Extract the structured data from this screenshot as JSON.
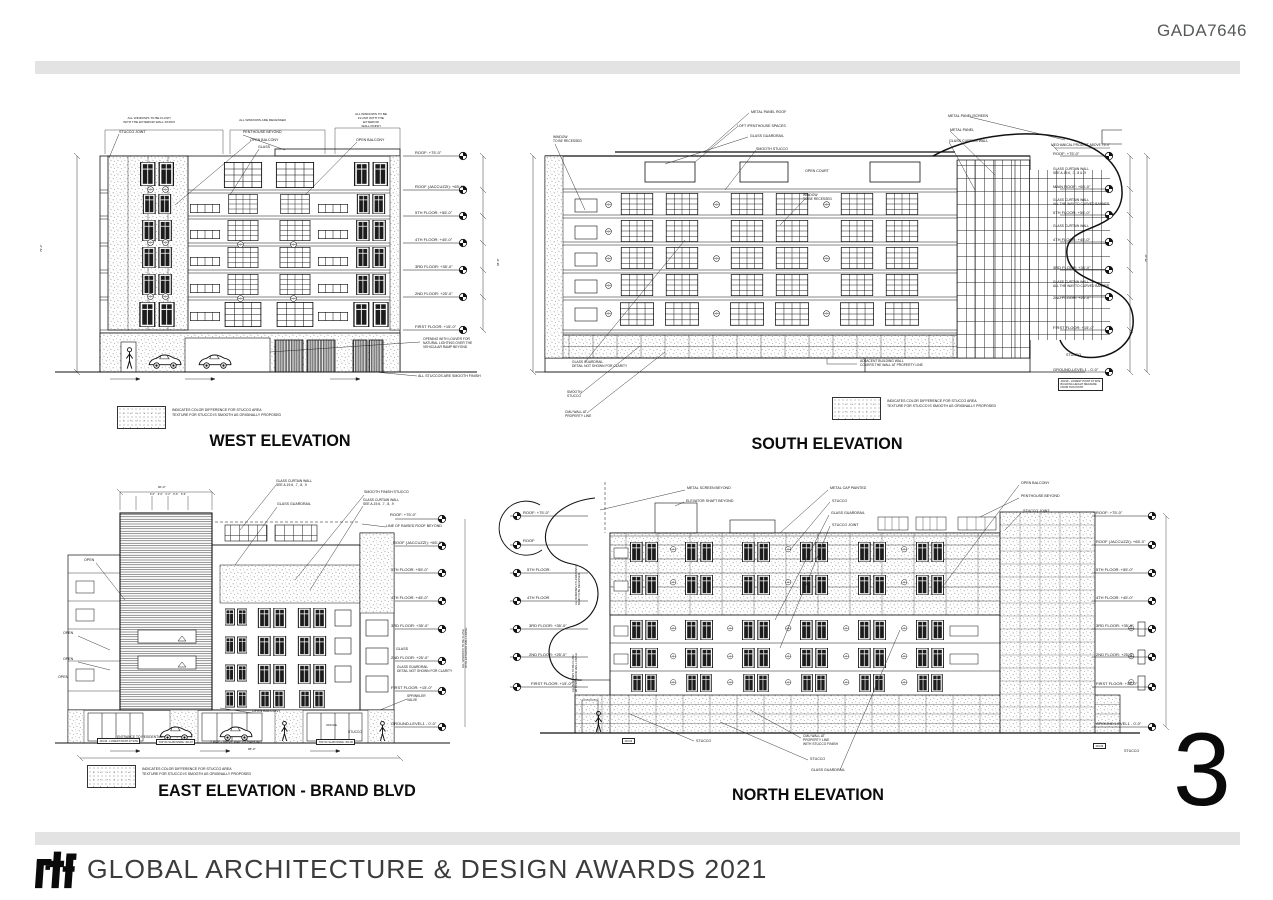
{
  "header": {
    "code": "GADA7646"
  },
  "page_number": "3",
  "footer": {
    "logo_text": "rtf",
    "award_text": "GLOBAL ARCHITECTURE & DESIGN AWARDS 2021"
  },
  "titles": {
    "west": "WEST ELEVATION",
    "south": "SOUTH ELEVATION",
    "east": "EAST ELEVATION - BRAND BLVD",
    "north": "NORTH ELEVATION"
  },
  "legend": {
    "line1": "INDICATES COLOR DIFFERENCE FOR STUCCO AREA",
    "line2": "TEXTURE FOR STUCCO IS SMOOTH AS ORIGINALLY PROPOSED",
    "positions": [
      {
        "x": 117,
        "y": 406
      },
      {
        "x": 832,
        "y": 397
      },
      {
        "x": 87,
        "y": 765
      }
    ]
  },
  "annotations": [
    {
      "t": "ALL WINDOWS TO BE FLUSH\nWITH THE EXTERIOR WALL FINISH",
      "x": 103,
      "y": 117,
      "fs": 3.1,
      "w": 92,
      "al": "center"
    },
    {
      "t": "ALL WINDOWS ARE RECESSED",
      "x": 215,
      "y": 119,
      "fs": 3.1,
      "w": 95,
      "al": "center"
    },
    {
      "t": "ALL WINDOWS TO BE\nFLUSH WITH THE\nEXTERIOR\nWALL FINISH",
      "x": 342,
      "y": 113,
      "fs": 3.1,
      "w": 58,
      "al": "center"
    },
    {
      "t": "STUCCO JOINT",
      "x": 119,
      "y": 130
    },
    {
      "t": "PENTHOUSE BEYOND",
      "x": 243,
      "y": 130
    },
    {
      "t": "OPEN BALCONY",
      "x": 250,
      "y": 138
    },
    {
      "t": "GLASS",
      "x": 258,
      "y": 145
    },
    {
      "t": "OPEN BALCONY",
      "x": 356,
      "y": 138
    },
    {
      "t": "ROOF: +75'-0\"",
      "x": 415,
      "y": 150,
      "fs": 4
    },
    {
      "t": "ROOF (JACCUZZI): +65'-0\"",
      "x": 415,
      "y": 184,
      "fs": 4
    },
    {
      "t": "5TH FLOOR: +55'-0\"",
      "x": 415,
      "y": 210,
      "fs": 4
    },
    {
      "t": "4TH FLOOR: +45'-0\"",
      "x": 415,
      "y": 237,
      "fs": 4
    },
    {
      "t": "3RD FLOOR: +35'-0\"",
      "x": 415,
      "y": 264,
      "fs": 4
    },
    {
      "t": "2ND FLOOR: +25'-0\"",
      "x": 415,
      "y": 291,
      "fs": 4
    },
    {
      "t": "FIRST FLOOR: +15'-0\"",
      "x": 415,
      "y": 324,
      "fs": 4
    },
    {
      "t": "OPENING WITH LOUVER FOR\nNATURAL LIGHTING OVER THE\nVEHICULAR RAMP BEYOND",
      "x": 423,
      "y": 337,
      "fs": 3.3
    },
    {
      "t": "ALL STUCCOS ARE SMOOTH FINISH",
      "x": 418,
      "y": 374
    },
    {
      "t": "68'-8\"",
      "x": 497,
      "y": 266,
      "fs": 3,
      "rot": -90
    },
    {
      "t": "79'-2\"",
      "x": 40,
      "y": 252,
      "fs": 3,
      "rot": -90
    },
    {
      "t": "WINDOW\nTO BE RECESSED",
      "x": 553,
      "y": 135,
      "fs": 3.3
    },
    {
      "t": "METAL PANEL ROOF",
      "x": 751,
      "y": 110
    },
    {
      "t": "LOFT /PENTHOUSE SPACES",
      "x": 737,
      "y": 124
    },
    {
      "t": "GLASS GUARDRAIL",
      "x": 750,
      "y": 134
    },
    {
      "t": "SMOOTH STUCCO",
      "x": 756,
      "y": 147
    },
    {
      "t": "OPEN COURT",
      "x": 805,
      "y": 169
    },
    {
      "t": "WINDOW\nTO BE RECESSED",
      "x": 803,
      "y": 193,
      "fs": 3.3
    },
    {
      "t": "METAL PANEL/SCREEN",
      "x": 948,
      "y": 114
    },
    {
      "t": "METAL PANEL",
      "x": 950,
      "y": 128
    },
    {
      "t": "GLASS CURTAIN WALL",
      "x": 949,
      "y": 139
    },
    {
      "t": "MECHANICAL PROJECT ABOVE 75'-0\"",
      "x": 1051,
      "y": 143,
      "fs": 3.3
    },
    {
      "t": "ROOF: +75'-0\"",
      "x": 1053,
      "y": 151,
      "fs": 4
    },
    {
      "t": "GLASS CURTAIN WALL\nSEE A-19.6, .7, .8 & .9",
      "x": 1053,
      "y": 167,
      "fs": 3.3
    },
    {
      "t": "MAIN ROOF: +65'-0\"",
      "x": 1053,
      "y": 184,
      "fs": 4
    },
    {
      "t": "GLASS CURTAIN WALL\nALL THE WAY TO CURVED BANNER",
      "x": 1053,
      "y": 198,
      "fs": 3.3
    },
    {
      "t": "5TH FLOOR: +55'-0\"",
      "x": 1053,
      "y": 210,
      "fs": 4
    },
    {
      "t": "GLASS CURTAIN WALL",
      "x": 1053,
      "y": 224,
      "fs": 3.3
    },
    {
      "t": "4TH FLOOR: +45'-0\"",
      "x": 1053,
      "y": 237,
      "fs": 4
    },
    {
      "t": "3RD FLOOR: +35'-0\"",
      "x": 1053,
      "y": 265,
      "fs": 4
    },
    {
      "t": "GLASS CURTAIN WALL\nALL THE WAY TO CURVED BANNER",
      "x": 1053,
      "y": 280,
      "fs": 3.3
    },
    {
      "t": "2ND FLOOR: +25'-0\"",
      "x": 1053,
      "y": 295,
      "fs": 4
    },
    {
      "t": "FIRST FLOOR: +15'-0\"",
      "x": 1053,
      "y": 325,
      "fs": 4
    },
    {
      "t": "STUCCO",
      "x": 1066,
      "y": 353
    },
    {
      "t": "GROUND-LEVEL1 - 0'-0\"",
      "x": 1053,
      "y": 367,
      "fs": 4
    },
    {
      "t": "404.96 - LOWEST POINT AT SITE\nBUILDING HEIGHT MEASURE\nFROM THIS POINT",
      "x": 1058,
      "y": 378,
      "fs": 2.6,
      "box": true
    },
    {
      "t": "GLASS GUARDRAIL\nDETAIL NOT SHOWN FOR CLARITY",
      "x": 572,
      "y": 360,
      "fs": 3.3
    },
    {
      "t": "SMOOTH\nSTUCCO",
      "x": 567,
      "y": 390,
      "fs": 3.3
    },
    {
      "t": "CMU WALL AT\nPROPERTY LINE",
      "x": 565,
      "y": 410,
      "fs": 3.3
    },
    {
      "t": "ADJACENT BUILDING WALL\nCOVERS THE WALL AT PROPERTY LINE",
      "x": 860,
      "y": 359,
      "fs": 3.3
    },
    {
      "t": "75'-0\"",
      "x": 1145,
      "y": 262,
      "fs": 3,
      "rot": -90
    },
    {
      "t": "GLASS CURTAIN WALL\nSEE A-19.6, .7, .8, .9",
      "x": 276,
      "y": 479,
      "fs": 3.3
    },
    {
      "t": "GLASS GUARDRAIL",
      "x": 277,
      "y": 502
    },
    {
      "t": "SMOOTH FINISH STUCCO",
      "x": 364,
      "y": 490
    },
    {
      "t": "GLASS CURTAIN WALL\nSEE A-19.6, .7, .8, .9",
      "x": 363,
      "y": 498,
      "fs": 3.3
    },
    {
      "t": "ROOF: +75'-0\"",
      "x": 390,
      "y": 512,
      "fs": 4
    },
    {
      "t": "LINE OF RAISED ROOF BEYOND",
      "x": 386,
      "y": 524
    },
    {
      "t": "ROOF (JACCUZZI): +65'-0\"",
      "x": 393,
      "y": 540,
      "fs": 4
    },
    {
      "t": "5TH FLOOR: +55'-0\"",
      "x": 391,
      "y": 567,
      "fs": 4
    },
    {
      "t": "4TH FLOOR: +45'-0\"",
      "x": 391,
      "y": 595,
      "fs": 4
    },
    {
      "t": "3RD FLOOR: +35'-0\"",
      "x": 391,
      "y": 623,
      "fs": 4
    },
    {
      "t": "GLASS",
      "x": 396,
      "y": 647
    },
    {
      "t": "2ND FLOOR: +25'-0\"",
      "x": 391,
      "y": 655,
      "fs": 4
    },
    {
      "t": "GLASS GUARDRAIL\nDETAIL NOT SHOWN FOR CLARITY",
      "x": 397,
      "y": 665,
      "fs": 3.3
    },
    {
      "t": "FIRST FLOOR: +15'-0\"",
      "x": 391,
      "y": 685,
      "fs": 4
    },
    {
      "t": "SPRINKLER\nVALVE",
      "x": 407,
      "y": 694,
      "fs": 3.3
    },
    {
      "t": "GROUND-LEVEL1 - 0'-0\"",
      "x": 391,
      "y": 721,
      "fs": 4
    },
    {
      "t": "OPEN",
      "x": 84,
      "y": 558
    },
    {
      "t": "OPEN",
      "x": 63,
      "y": 631
    },
    {
      "t": "OPEN",
      "x": 63,
      "y": 657
    },
    {
      "t": "OPEN",
      "x": 58,
      "y": 675
    },
    {
      "t": "90'-0\"",
      "x": 158,
      "y": 486,
      "fs": 3
    },
    {
      "t": "8'-6\"    8'-6\"    5'-0\"    8'-6\"    8'-6\"",
      "x": 118,
      "y": 493,
      "fs": 2.5,
      "w": 100,
      "al": "center"
    },
    {
      "t": "OPEN BALCONY",
      "x": 252,
      "y": 709
    },
    {
      "t": "ENTRANCE TO RESIDENTIAL",
      "x": 117,
      "y": 735,
      "fs": 3.3
    },
    {
      "t": "2 WAY - DRIVE WAY TO PARKING",
      "x": 210,
      "y": 740,
      "fs": 3.3
    },
    {
      "t": "OFFICE",
      "x": 326,
      "y": 724,
      "fs": 3
    },
    {
      "t": "STUCCO",
      "x": 348,
      "y": 730,
      "fs": 3.3
    },
    {
      "t": "404.96 - LOWEST POINT AT SITE",
      "x": 97,
      "y": 738,
      "fs": 2.5,
      "box": true
    },
    {
      "t": "TOP OF SLAB INSIDE: 404.87",
      "x": 156,
      "y": 739,
      "fs": 2.5,
      "box": true
    },
    {
      "t": "TOP OF SLAB INSIDE: 404.96",
      "x": 316,
      "y": 739,
      "fs": 2.5,
      "box": true
    },
    {
      "t": "88'-0\"",
      "x": 248,
      "y": 748,
      "fs": 3
    },
    {
      "t": "ALL WINDOWS TO BE FLUSH\nWITH EXTERIOR WALL FINISH",
      "x": 462,
      "y": 668,
      "fs": 2.8,
      "rot": -90
    },
    {
      "t": "METAL SCREEN BEYOND",
      "x": 687,
      "y": 486
    },
    {
      "t": "ELEVATOR SHAFT BEYOND",
      "x": 686,
      "y": 499
    },
    {
      "t": "METAL CAP PAINTED",
      "x": 830,
      "y": 486
    },
    {
      "t": "STUCCO",
      "x": 832,
      "y": 499
    },
    {
      "t": "GLASS GUARDRAIL",
      "x": 831,
      "y": 511
    },
    {
      "t": "STUCCO JOINT",
      "x": 832,
      "y": 523
    },
    {
      "t": "OPEN BALCONY",
      "x": 1021,
      "y": 481
    },
    {
      "t": "PENTHOUSE BEYOND",
      "x": 1021,
      "y": 494
    },
    {
      "t": "STUCCO JOINT",
      "x": 1023,
      "y": 509
    },
    {
      "t": "ROOF: +75'-0\"",
      "x": 523,
      "y": 510,
      "fs": 4
    },
    {
      "t": "ROOF",
      "x": 523,
      "y": 538,
      "fs": 4
    },
    {
      "t": "5TH FLOOR:",
      "x": 527,
      "y": 567,
      "fs": 4
    },
    {
      "t": "4TH FLOOR",
      "x": 527,
      "y": 595,
      "fs": 4
    },
    {
      "t": "3RD FLOOR: +35'-0\"",
      "x": 529,
      "y": 623,
      "fs": 4
    },
    {
      "t": "2ND FLOOR: +25'-0\"",
      "x": 529,
      "y": 652,
      "fs": 4
    },
    {
      "t": "FIRST FLOOR: +15'-0\"",
      "x": 531,
      "y": 681,
      "fs": 4
    },
    {
      "t": "ALL WINDOWS AT HORIZONTAL\nBAND TO BE RECESSED",
      "x": 575,
      "y": 605,
      "fs": 2.7,
      "rot": -90
    },
    {
      "t": "ALL WINDOWS TO BE FLUSH\nWITH EXTERIOR WALL FINISH",
      "x": 572,
      "y": 692,
      "fs": 2.7,
      "rot": -90
    },
    {
      "t": "ROOF: +75'-0\"",
      "x": 1096,
      "y": 510,
      "fs": 4
    },
    {
      "t": "ROOF (JACCUZZI): +65'-0\"",
      "x": 1096,
      "y": 539,
      "fs": 4
    },
    {
      "t": "5TH FLOOR: +55'-0\"",
      "x": 1096,
      "y": 567,
      "fs": 4
    },
    {
      "t": "4TH FLOOR: +45'-0\"",
      "x": 1096,
      "y": 595,
      "fs": 4
    },
    {
      "t": "3RD FLOOR: +35'-0\"",
      "x": 1096,
      "y": 623,
      "fs": 4
    },
    {
      "t": "2ND FLOOR: +25'-0\"",
      "x": 1096,
      "y": 652,
      "fs": 4
    },
    {
      "t": "FIRST FLOOR: +15'-0\"",
      "x": 1096,
      "y": 681,
      "fs": 4
    },
    {
      "t": "GROUND-LEVEL1 - 0'-0\"",
      "x": 1096,
      "y": 721,
      "fs": 4
    },
    {
      "t": "STUCCO",
      "x": 1124,
      "y": 749
    },
    {
      "t": "STUCCO",
      "x": 696,
      "y": 739
    },
    {
      "t": "CMU WALL AT\nPROPERTY LINE\nWITH STUCCO FINISH",
      "x": 803,
      "y": 734,
      "fs": 3.3
    },
    {
      "t": "STUCCO",
      "x": 810,
      "y": 757
    },
    {
      "t": "GLASS GUARDRAIL",
      "x": 811,
      "y": 768
    },
    {
      "t": "404.96",
      "x": 622,
      "y": 738,
      "fs": 2.5,
      "box": true
    },
    {
      "t": "404.96",
      "x": 1093,
      "y": 743,
      "fs": 2.5,
      "box": true
    }
  ]
}
